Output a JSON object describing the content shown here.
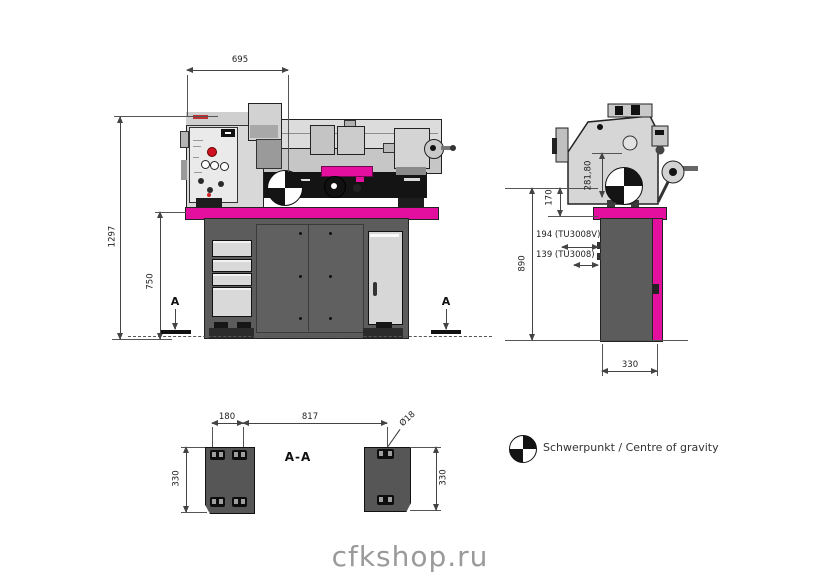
{
  "page": {
    "watermark": "cfkshop.ru"
  },
  "legend": {
    "label": "Schwerpunkt / Centre of gravity"
  },
  "front_view": {
    "dim_width_top": "695",
    "dim_total_height": "1297",
    "dim_stand_height": "750",
    "section_marker_left": "A",
    "section_marker_right": "A"
  },
  "side_view": {
    "dim_head": "281,80",
    "dim_center_to_stand": "170",
    "dim_variant_v": "194 (TU3008V)",
    "dim_variant_std": "139 (TU3008)",
    "dim_total_height": "890",
    "dim_stand_depth": "330"
  },
  "section_view": {
    "title": "A-A",
    "dim_slot_spacing": "180",
    "dim_foot_spacing": "817",
    "dim_hole_diameter": "Ø18",
    "dim_left_foot_depth": "330",
    "dim_right_foot_depth": "330"
  },
  "colors": {
    "accent_magenta": "#e40f9f",
    "stand_gray": "#5c5c5c",
    "line": "#444444"
  }
}
